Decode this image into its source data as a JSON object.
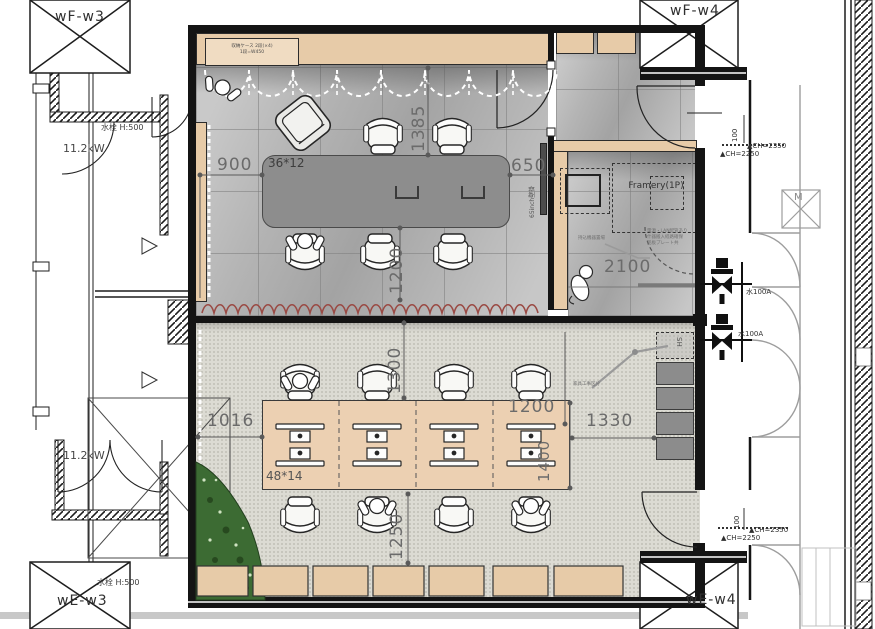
{
  "columns": {
    "top_left": "wF-w3",
    "top_right": "wF-w4",
    "bottom_left": "wE-w3",
    "bottom_right": "wE-w4",
    "m_box": "M"
  },
  "left": {
    "power_top": "11.2kW",
    "tap_top": "水栓 H:500",
    "power_bottom": "11.2kW",
    "tap_bottom": "水栓 H:500"
  },
  "meeting": {
    "table": "36*12",
    "d900": "900",
    "d650": "650",
    "d1385": "1385",
    "d1200": "1200",
    "storage1": "収納ケース 2段(×4)",
    "storage2": "1段=W450",
    "tv": "65inch壁掛"
  },
  "framery": {
    "name": "Framery(1P)",
    "d2100": "2100",
    "note1": "電源・LAN配管あり",
    "note2": "什器搬入経路確保",
    "note3": "銘板プレート共",
    "lead": "持込機器置場"
  },
  "work": {
    "desk": "48*14",
    "d1016": "1016",
    "d1300": "1300",
    "d1200": "1200",
    "d1330": "1330",
    "d1400": "1400",
    "d1250": "1250",
    "sh": "SH",
    "lead": "家具工事区分"
  },
  "right": {
    "ch2350": "▲CH=2350",
    "ch2250": "▲CH=2250",
    "d100": "100",
    "water": "水100A"
  }
}
